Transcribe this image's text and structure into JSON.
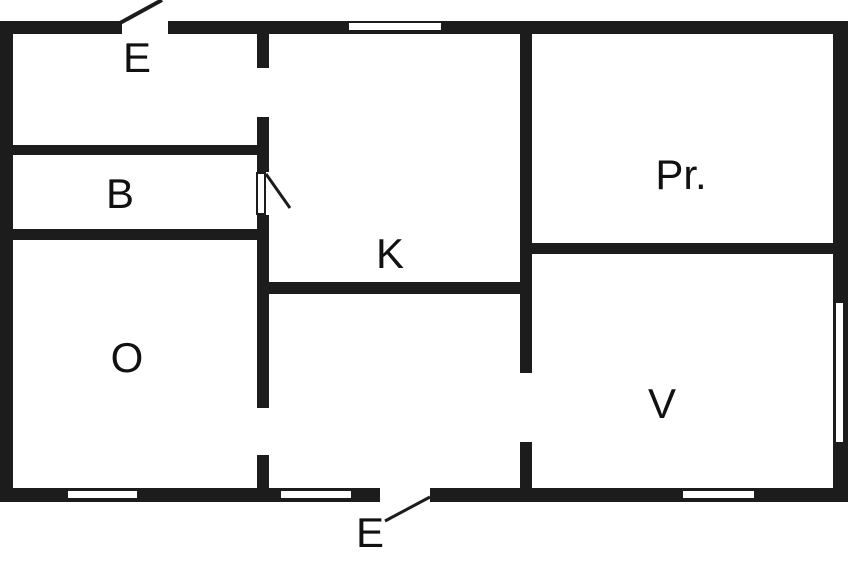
{
  "diagram": {
    "type": "floor-plan",
    "background_color": "#ffffff",
    "wall_color": "#1c1c1c",
    "line_color": "#1c1c1c",
    "canvas": {
      "width": 848,
      "height": 565
    },
    "rooms": [
      {
        "id": "entry-top",
        "label": "E",
        "cx": 137,
        "cy": 58
      },
      {
        "id": "bathroom",
        "label": "B",
        "cx": 120,
        "cy": 194
      },
      {
        "id": "room-o",
        "label": "O",
        "cx": 127,
        "cy": 358
      },
      {
        "id": "kitchen",
        "label": "K",
        "cx": 390,
        "cy": 254
      },
      {
        "id": "room-pr",
        "label": "Pr.",
        "cx": 681,
        "cy": 175
      },
      {
        "id": "room-v",
        "label": "V",
        "cx": 662,
        "cy": 404
      },
      {
        "id": "entry-bottom",
        "label": "E",
        "cx": 370,
        "cy": 533
      }
    ],
    "walls": [
      {
        "id": "top-wall-left",
        "x": 0,
        "y": 21,
        "w": 122,
        "h": 13
      },
      {
        "id": "top-wall-right",
        "x": 168,
        "y": 21,
        "w": 680,
        "h": 13
      },
      {
        "id": "left-wall",
        "x": 0,
        "y": 21,
        "w": 13,
        "h": 481
      },
      {
        "id": "right-wall",
        "x": 833,
        "y": 21,
        "w": 15,
        "h": 481
      },
      {
        "id": "bottom-wall-left",
        "x": 0,
        "y": 488,
        "w": 380,
        "h": 14
      },
      {
        "id": "bottom-wall-right",
        "x": 430,
        "y": 488,
        "w": 418,
        "h": 14
      },
      {
        "id": "inner-v1-seg1",
        "x": 257,
        "y": 33,
        "w": 12,
        "h": 35
      },
      {
        "id": "inner-v1-seg2",
        "x": 257,
        "y": 117,
        "w": 12,
        "h": 55
      },
      {
        "id": "inner-v1-seg3",
        "x": 257,
        "y": 215,
        "w": 12,
        "h": 193
      },
      {
        "id": "inner-v1-seg4",
        "x": 257,
        "y": 455,
        "w": 12,
        "h": 33
      },
      {
        "id": "inner-v2-seg1",
        "x": 520,
        "y": 33,
        "w": 12,
        "h": 340
      },
      {
        "id": "inner-v2-seg2",
        "x": 520,
        "y": 442,
        "w": 12,
        "h": 46
      },
      {
        "id": "wall-e-b",
        "x": 13,
        "y": 145,
        "w": 256,
        "h": 10
      },
      {
        "id": "wall-b-o",
        "x": 13,
        "y": 229,
        "w": 256,
        "h": 11
      },
      {
        "id": "wall-k-bottom",
        "x": 257,
        "y": 282,
        "w": 275,
        "h": 12
      },
      {
        "id": "wall-pr-v",
        "x": 520,
        "y": 243,
        "w": 313,
        "h": 11
      }
    ],
    "windows": [
      {
        "id": "window-top",
        "x": 348,
        "y": 22,
        "w": 94,
        "h": 9,
        "outlined": true
      },
      {
        "id": "window-bottom-1",
        "x": 67,
        "y": 490,
        "w": 71,
        "h": 9,
        "outlined": true
      },
      {
        "id": "window-bottom-2",
        "x": 280,
        "y": 490,
        "w": 72,
        "h": 9,
        "outlined": true
      },
      {
        "id": "window-bottom-3",
        "x": 682,
        "y": 490,
        "w": 73,
        "h": 9,
        "outlined": true
      },
      {
        "id": "window-right",
        "x": 836,
        "y": 303,
        "w": 7,
        "h": 139,
        "outlined": false
      }
    ],
    "door_leaf": {
      "id": "door-leaf-b",
      "x": 256,
      "y": 172,
      "w": 10,
      "h": 43
    },
    "door_lines": [
      {
        "id": "door-swing-top",
        "x1": 120,
        "y1": 23,
        "x2": 162,
        "y2": 0,
        "width": 4
      },
      {
        "id": "door-swing-b",
        "x1": 266,
        "y1": 174,
        "x2": 290,
        "y2": 208,
        "width": 3
      },
      {
        "id": "leader-entry-bottom",
        "x1": 385,
        "y1": 521,
        "x2": 430,
        "y2": 497,
        "width": 3
      }
    ]
  }
}
